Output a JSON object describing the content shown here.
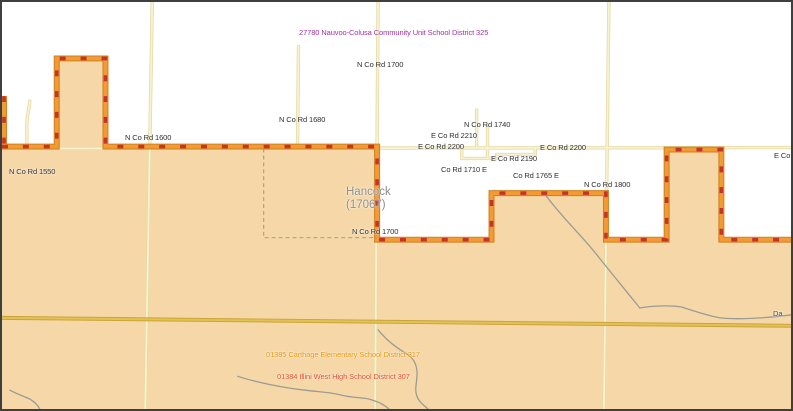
{
  "map": {
    "title_hint": "School district map, Hancock County area",
    "county": {
      "name": "Hancock",
      "fips": "(17067)"
    },
    "districts": {
      "nauvoo_colusa": "27780 Nauvoo-Colusa Community Unit School District 325",
      "carthage_elementary": "01385 Carthage Elementary School District 317",
      "illini_west": "01384 Illini West High School District 307"
    },
    "road_labels": {
      "n_co_rd_1700_top": "N Co Rd 1700",
      "n_co_rd_1680": "N Co Rd 1680",
      "n_co_rd_1600": "N Co Rd 1600",
      "n_co_rd_1550": "N Co Rd 1550",
      "n_co_rd_1740": "N Co Rd 1740",
      "e_co_rd_2210": "E Co Rd 2210",
      "e_co_rd_2200_left": "E Co Rd 2200",
      "e_co_rd_2200_right": "E Co Rd 2200",
      "e_co_rd_2190": "E Co Rd 2190",
      "co_rd_1710_e": "Co Rd 1710 E",
      "co_rd_1765_e": "Co Rd 1765 E",
      "n_co_rd_1800": "N Co Rd 1800",
      "n_co_rd_1700_bottom": "N Co Rd 1700",
      "e_co_partial_right_edge": "E Co"
    },
    "stream_labels": {
      "da_partial_right_edge": "Da"
    },
    "colors": {
      "district_fill_tan": "#F6D8A8",
      "boundary_orange": "#F29A33",
      "boundary_edge": "#D07F1F",
      "boundary_red_dash": "#C63428",
      "road_pale_yellow": "#F8F2D0",
      "road_gold": "#E3C253",
      "stream_gray": "#9B9B93",
      "township_dash": "#A9A77D",
      "label_purple": "#A134A1",
      "label_orange": "#E8940C",
      "label_red": "#E34B27",
      "county_gray": "#8E8E8E"
    }
  }
}
